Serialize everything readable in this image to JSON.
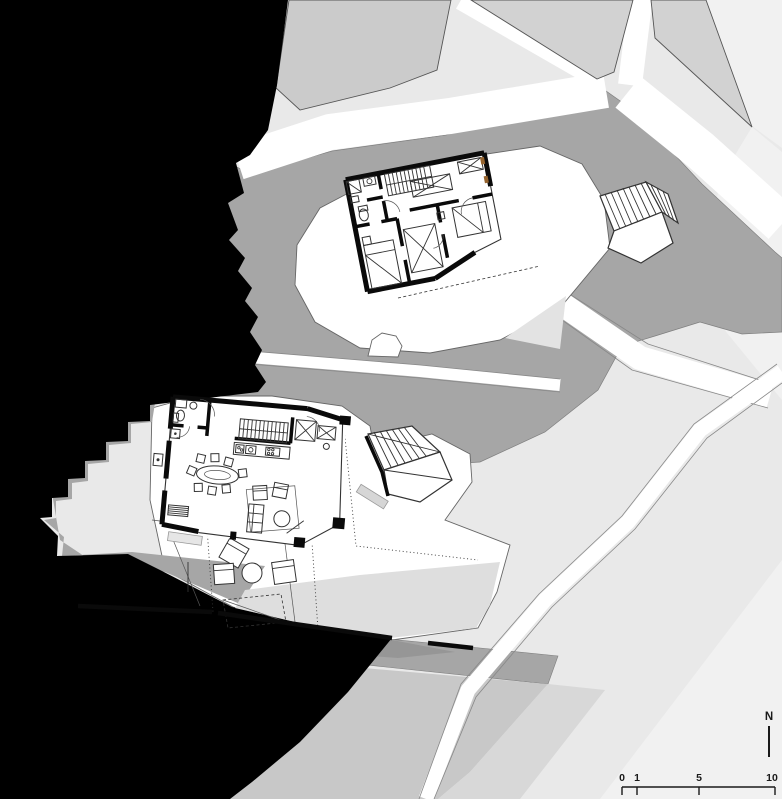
{
  "north": {
    "label": "N"
  },
  "scale_bar": {
    "labels": [
      "0",
      "1",
      "5",
      "10"
    ]
  },
  "palette": {
    "sea": "#000000",
    "terrain_dark": "#a6a6a6",
    "terrain_darker": "#969696",
    "terrain_mid": "#c8c8c8",
    "terrain_light": "#d8d8d8",
    "parcel": "#d2d2d2",
    "parcel_warm": "#cbcbcb",
    "field": "#e9e9e9",
    "field_light": "#f1f1f1",
    "terrace": "#dedede",
    "paper": "#ffffff",
    "wall": "#0a0a0a",
    "accent_wood": "#96642e"
  }
}
